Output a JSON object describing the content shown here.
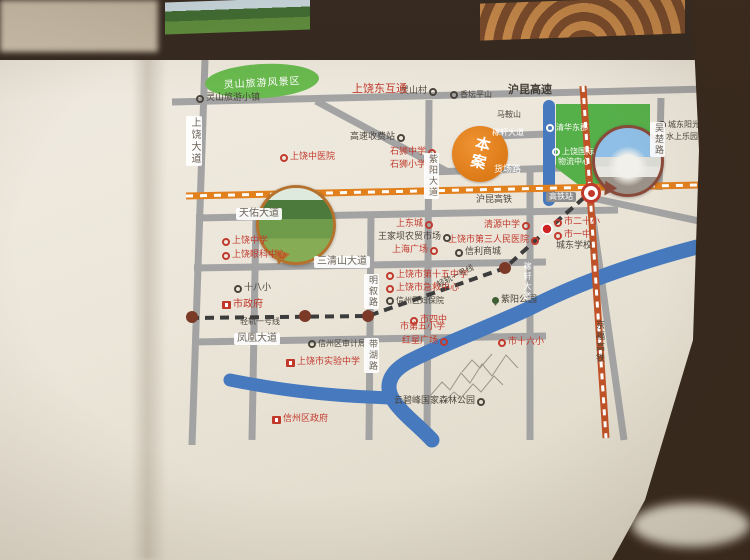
{
  "map": {
    "scenic_area": {
      "label": "灵山旅游风景区"
    },
    "project": {
      "label": "本案"
    },
    "station_marker_label": "高铁站",
    "colors": {
      "page": "#ece6da",
      "road": "#a3a3a3",
      "hukun_hsr": "#e2801e",
      "jingfu_hsr": "#bf5226",
      "light_rail": "#3c3c3c",
      "river": "#4679bd",
      "green_zone": "#56b04a",
      "project_orange": "#dd7a18",
      "poi_red": "#c13a2e",
      "poi_dark": "#4a443c"
    },
    "green_zone_labels_note": "white POI labels inside green development zone",
    "labels": [
      {
        "id": "lingshan-town",
        "t": "灵山旅游小镇",
        "x": 196,
        "y": 94,
        "type": "dark",
        "m": "left",
        "fs": 9
      },
      {
        "id": "lingshan-village",
        "t": "灵山村",
        "x": 400,
        "y": 87,
        "type": "dark",
        "m": "right",
        "fs": 9
      },
      {
        "id": "xiangtanping-hill",
        "t": "香坛平山",
        "x": 450,
        "y": 91,
        "type": "dark",
        "m": "left",
        "fs": 8
      },
      {
        "id": "toll-station",
        "t": "高速收费站",
        "x": 350,
        "y": 133,
        "type": "dark",
        "m": "right",
        "fs": 9
      },
      {
        "id": "maanshan",
        "t": "马鞍山",
        "x": 497,
        "y": 111,
        "type": "dark",
        "m": "none",
        "fs": 8
      },
      {
        "id": "wangjiaba-market",
        "t": "王家坝农贸市场",
        "x": 378,
        "y": 233,
        "type": "dark",
        "m": "right",
        "fs": 9
      },
      {
        "id": "xinli-mall",
        "t": "信利商城",
        "x": 455,
        "y": 248,
        "type": "dark",
        "m": "left",
        "fs": 9
      },
      {
        "id": "chengdong-school",
        "t": "城东学校",
        "x": 556,
        "y": 242,
        "type": "dark",
        "m": "none",
        "fs": 9
      },
      {
        "id": "shenzhou-audit-bureau",
        "t": "信州区审计局",
        "x": 308,
        "y": 340,
        "type": "dark",
        "m": "left",
        "fs": 8
      },
      {
        "id": "shibaxiao-school",
        "t": "十八小",
        "x": 234,
        "y": 284,
        "type": "dark",
        "m": "left",
        "fs": 9
      },
      {
        "id": "ziyang-park",
        "t": "紫阳公园",
        "x": 492,
        "y": 296,
        "type": "dark",
        "m": "tree",
        "fs": 9
      },
      {
        "id": "yunbifeng-forest-park",
        "t": "云碧峰国家森林公园",
        "x": 394,
        "y": 397,
        "type": "dark",
        "m": "right",
        "fs": 9
      },
      {
        "id": "chengdong-sunshine",
        "t": "城东阳光",
        "x": 658,
        "y": 121,
        "type": "dark",
        "m": "left",
        "fs": 8
      },
      {
        "id": "water-park",
        "t": "水上乐园",
        "x": 666,
        "y": 133,
        "type": "dark",
        "m": "none",
        "fs": 8
      },
      {
        "id": "shangrao-east-interchange",
        "t": "上饶东互通",
        "x": 352,
        "y": 83,
        "type": "red",
        "m": "none",
        "fs": 11
      },
      {
        "id": "shangrao-tcm-hospital",
        "t": "上饶中医院",
        "x": 280,
        "y": 153,
        "type": "red",
        "m": "left",
        "fs": 9
      },
      {
        "id": "shishi-middle-school",
        "t": "石狮中学",
        "x": 390,
        "y": 148,
        "type": "red",
        "m": "right",
        "fs": 9
      },
      {
        "id": "shishi-primary-school",
        "t": "石狮小学",
        "x": 390,
        "y": 161,
        "type": "red",
        "m": "right",
        "fs": 9
      },
      {
        "id": "shangdongcheng",
        "t": "上东城",
        "x": 396,
        "y": 220,
        "type": "red",
        "m": "right",
        "fs": 9
      },
      {
        "id": "shanghai-plaza",
        "t": "上海广场",
        "x": 392,
        "y": 246,
        "type": "red",
        "m": "right",
        "fs": 9
      },
      {
        "id": "qingyuan-middle-school",
        "t": "清源中学",
        "x": 484,
        "y": 221,
        "type": "red",
        "m": "right",
        "fs": 9
      },
      {
        "id": "third-peoples-hospital",
        "t": "上饶市第三人民医院",
        "x": 448,
        "y": 236,
        "type": "red",
        "m": "right",
        "fs": 9
      },
      {
        "id": "ershixiao-school",
        "t": "市二十小",
        "x": 554,
        "y": 218,
        "type": "red",
        "m": "left",
        "fs": 9
      },
      {
        "id": "yizhong-school",
        "t": "市一中",
        "x": 554,
        "y": 231,
        "type": "red",
        "m": "left",
        "fs": 9
      },
      {
        "id": "shangrao-middle-school",
        "t": "上饶中学",
        "x": 222,
        "y": 237,
        "type": "red",
        "m": "left",
        "fs": 9
      },
      {
        "id": "shangrao-eye-center",
        "t": "上饶眼科中心",
        "x": 222,
        "y": 251,
        "type": "red",
        "m": "left",
        "fs": 9
      },
      {
        "id": "city-government",
        "t": "市政府",
        "x": 222,
        "y": 300,
        "type": "red",
        "m": "gov",
        "fs": 10
      },
      {
        "id": "fifteenth-middle-school",
        "t": "上饶市第十五中学",
        "x": 386,
        "y": 271,
        "type": "red",
        "m": "left",
        "fs": 9
      },
      {
        "id": "emergency-center",
        "t": "上饶市急救中心",
        "x": 386,
        "y": 284,
        "type": "red",
        "m": "left",
        "fs": 9
      },
      {
        "id": "shenzhou-fubao-hospital",
        "t": "信州区妇保院",
        "x": 386,
        "y": 297,
        "type": "dark",
        "m": "left",
        "fs": 8
      },
      {
        "id": "sizhong-school",
        "t": "市四中",
        "x": 410,
        "y": 316,
        "type": "red",
        "m": "left",
        "fs": 9
      },
      {
        "id": "fifth-primary-school",
        "t": "市第五小学",
        "x": 400,
        "y": 323,
        "type": "red",
        "m": "none",
        "fs": 9
      },
      {
        "id": "hongxing-plaza",
        "t": "红星广场",
        "x": 402,
        "y": 337,
        "type": "red",
        "m": "right",
        "fs": 9
      },
      {
        "id": "shiliuxiao-school",
        "t": "市十六小",
        "x": 498,
        "y": 338,
        "type": "red",
        "m": "left",
        "fs": 9
      },
      {
        "id": "experimental-middle-school",
        "t": "上饶市实验中学",
        "x": 286,
        "y": 358,
        "type": "red",
        "m": "gov",
        "fs": 9
      },
      {
        "id": "shenzhou-district-government",
        "t": "信州区政府",
        "x": 272,
        "y": 415,
        "type": "red",
        "m": "gov",
        "fs": 9
      },
      {
        "id": "qinghua-east-estate",
        "t": "清华东郡",
        "x": 546,
        "y": 124,
        "type": "white",
        "m": "left",
        "fs": 8
      },
      {
        "id": "intl-logistics-line1",
        "t": "上饶国际",
        "x": 552,
        "y": 148,
        "type": "white",
        "m": "left",
        "fs": 8
      },
      {
        "id": "intl-logistics-line2",
        "t": "物流中心",
        "x": 558,
        "y": 158,
        "type": "white",
        "m": "none",
        "fs": 8
      },
      {
        "id": "road-tianyou-ave",
        "t": "天佑大道",
        "x": 236,
        "y": 208,
        "type": "chip",
        "m": "none",
        "fs": 10
      },
      {
        "id": "road-sanqingshan-ave",
        "t": "三清山大道",
        "x": 314,
        "y": 256,
        "type": "chip",
        "m": "none",
        "fs": 10
      },
      {
        "id": "road-fenghuang-ave",
        "t": "凤凰大道",
        "x": 234,
        "y": 333,
        "type": "chip",
        "m": "none",
        "fs": 10
      },
      {
        "id": "road-shangrao-ave",
        "t": "上饶大道",
        "x": 186,
        "y": 116,
        "type": "chip",
        "m": "none",
        "vert": true,
        "fs": 10
      },
      {
        "id": "road-ziyang-ave",
        "t": "紫阳大道",
        "x": 424,
        "y": 153,
        "type": "chip",
        "m": "none",
        "vert": true,
        "fs": 9
      },
      {
        "id": "road-mingxu-rd",
        "t": "明叙路",
        "x": 364,
        "y": 274,
        "type": "chip",
        "m": "none",
        "vert": true,
        "fs": 9
      },
      {
        "id": "road-daihu-rd",
        "t": "带湖路",
        "x": 364,
        "y": 338,
        "type": "chip",
        "m": "none",
        "vert": true,
        "fs": 9
      },
      {
        "id": "road-wuchu-rd",
        "t": "吴楚路",
        "x": 650,
        "y": 122,
        "type": "chip",
        "m": "none",
        "vert": true,
        "fs": 9
      },
      {
        "id": "road-hukun-expressway",
        "t": "沪昆高速",
        "x": 508,
        "y": 84,
        "type": "darkbold",
        "m": "none",
        "fs": 11
      },
      {
        "id": "rail-hukun-hsr",
        "t": "沪昆高铁",
        "x": 476,
        "y": 196,
        "type": "dark",
        "m": "none",
        "fs": 9
      },
      {
        "id": "rail-jingfu-hsr",
        "t": "京福高铁",
        "x": 594,
        "y": 320,
        "type": "dark",
        "m": "none",
        "vert": true,
        "fs": 9
      },
      {
        "id": "rail-light-rail-1a",
        "t": "轻轨一号线",
        "x": 240,
        "y": 318,
        "type": "dark",
        "m": "none",
        "fs": 8
      },
      {
        "id": "rail-light-rail-1b",
        "t": "轻轨一号线",
        "x": 436,
        "y": 282,
        "type": "dark",
        "m": "none",
        "fs": 8,
        "rot": -27
      },
      {
        "id": "hsr-station-chip",
        "t": "高铁站",
        "x": 546,
        "y": 192,
        "type": "chipdark",
        "m": "none",
        "fs": 8
      },
      {
        "id": "road-huochang-rd",
        "t": "货场路",
        "x": 494,
        "y": 166,
        "type": "onroad",
        "m": "none",
        "fs": 9
      },
      {
        "id": "road-jiaxuan-ave-h",
        "t": "稼轩大道",
        "x": 492,
        "y": 129,
        "type": "onroad",
        "m": "none",
        "fs": 8
      },
      {
        "id": "road-jiaxuan-ave-v",
        "t": "稼轩大道",
        "x": 523,
        "y": 262,
        "type": "onroad",
        "m": "none",
        "vert": true,
        "fs": 8
      }
    ]
  }
}
